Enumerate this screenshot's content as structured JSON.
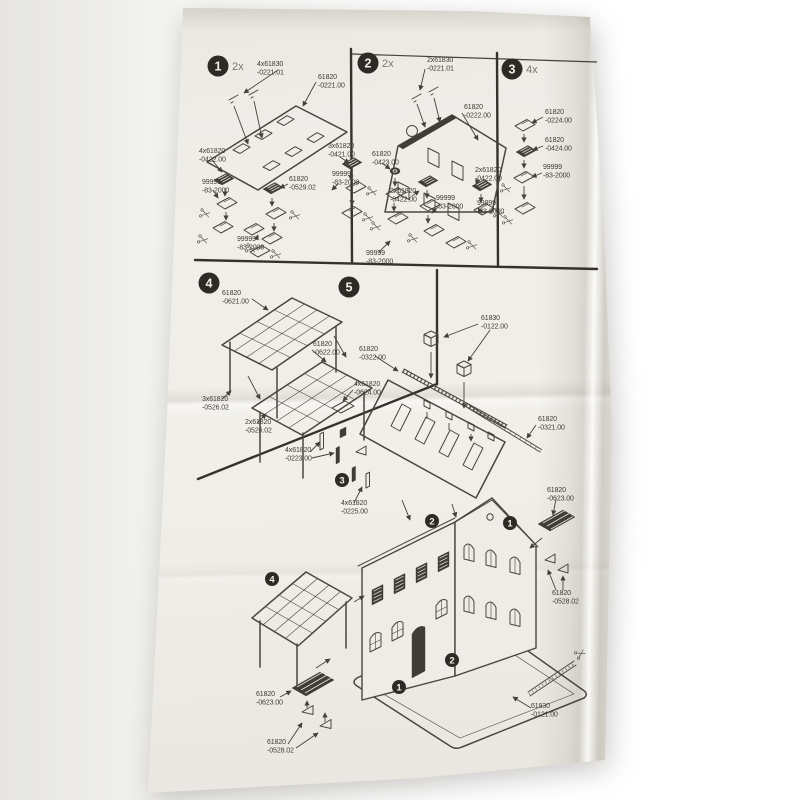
{
  "colors": {
    "paper": "#efede8",
    "ink": "#4a463f",
    "badge": "#2e2b27"
  },
  "steps": [
    {
      "num": "1",
      "qty": "2x",
      "badge": {
        "x": 218,
        "y": 66
      },
      "labels": [
        {
          "l1": "4x61830",
          "l2": "-0221.01",
          "x": 257,
          "y": 66
        },
        {
          "l1": "61820",
          "l2": "-0221.00",
          "x": 318,
          "y": 79
        },
        {
          "l1": "4x61820",
          "l2": "-0422.00",
          "x": 199,
          "y": 153
        },
        {
          "l1": "3x61820",
          "l2": "-0421.00",
          "x": 328,
          "y": 148
        },
        {
          "l1": "99999",
          "l2": "-83-2000",
          "x": 202,
          "y": 184
        },
        {
          "l1": "61820",
          "l2": "-0529.02",
          "x": 289,
          "y": 181
        },
        {
          "l1": "99999",
          "l2": "-83-2000",
          "x": 332,
          "y": 176
        },
        {
          "l1": "99999",
          "l2": "-83-2000",
          "x": 237,
          "y": 241
        }
      ]
    },
    {
      "num": "2",
      "qty": "2x",
      "badge": {
        "x": 368,
        "y": 63
      },
      "labels": [
        {
          "l1": "2x61830",
          "l2": "-0221.01",
          "x": 427,
          "y": 62
        },
        {
          "l1": "61820",
          "l2": "-0222.00",
          "x": 464,
          "y": 109
        },
        {
          "l1": "61820",
          "l2": "-0423.00",
          "x": 372,
          "y": 156
        },
        {
          "l1": "2x61820",
          "l2": "-0422.00",
          "x": 390,
          "y": 193
        },
        {
          "l1": "99999",
          "l2": "-83-2000",
          "x": 436,
          "y": 200
        },
        {
          "l1": "2x61820",
          "l2": "-0422.00",
          "x": 475,
          "y": 172
        },
        {
          "l1": "99999",
          "l2": "-83-2000",
          "x": 477,
          "y": 205
        },
        {
          "l1": "99999",
          "l2": "-83-2000",
          "x": 366,
          "y": 255
        }
      ]
    },
    {
      "num": "3",
      "qty": "4x",
      "badge": {
        "x": 512,
        "y": 69
      },
      "labels": [
        {
          "l1": "61820",
          "l2": "-0224.00",
          "x": 545,
          "y": 114
        },
        {
          "l1": "61820",
          "l2": "-0424.00",
          "x": 545,
          "y": 142
        },
        {
          "l1": "99999",
          "l2": "-83-2000",
          "x": 543,
          "y": 169
        }
      ]
    },
    {
      "num": "4",
      "qty": "",
      "badge": {
        "x": 209,
        "y": 283
      },
      "labels": [
        {
          "l1": "61820",
          "l2": "-0621.00",
          "x": 222,
          "y": 295
        },
        {
          "l1": "61820",
          "l2": "-0622.00",
          "x": 313,
          "y": 346
        },
        {
          "l1": "3x61820",
          "l2": "-0526.02",
          "x": 202,
          "y": 401
        },
        {
          "l1": "2x61820",
          "l2": "-0526.02",
          "x": 245,
          "y": 424
        }
      ]
    },
    {
      "num": "5",
      "qty": "",
      "badge": {
        "x": 349,
        "y": 287
      },
      "labels": [
        {
          "l1": "61830",
          "l2": "-0122.00",
          "x": 481,
          "y": 320
        },
        {
          "l1": "61820",
          "l2": "-0322.00",
          "x": 359,
          "y": 351
        },
        {
          "l1": "4x61820",
          "l2": "-0624.00",
          "x": 354,
          "y": 386
        },
        {
          "l1": "61820",
          "l2": "-0321.00",
          "x": 538,
          "y": 421
        },
        {
          "l1": "4x61820",
          "l2": "-0223.00",
          "x": 285,
          "y": 452
        },
        {
          "l1": "4x61820",
          "l2": "-0225.00",
          "x": 341,
          "y": 505
        },
        {
          "l1": "61820",
          "l2": "-0623.00",
          "x": 547,
          "y": 492
        },
        {
          "l1": "61820",
          "l2": "-0528.02",
          "x": 552,
          "y": 595
        },
        {
          "l1": "61820",
          "l2": "-0623.00",
          "x": 256,
          "y": 696
        },
        {
          "l1": "61820",
          "l2": "-0528.02",
          "x": 267,
          "y": 744
        },
        {
          "l1": "61830",
          "l2": "-0121.00",
          "x": 531,
          "y": 708
        }
      ]
    }
  ],
  "assembly_markers": [
    {
      "num": "3",
      "x": 342,
      "y": 480
    },
    {
      "num": "2",
      "x": 432,
      "y": 521
    },
    {
      "num": "1",
      "x": 510,
      "y": 523
    },
    {
      "num": "4",
      "x": 272,
      "y": 579
    },
    {
      "num": "2",
      "x": 452,
      "y": 660
    },
    {
      "num": "1",
      "x": 399,
      "y": 687
    }
  ]
}
